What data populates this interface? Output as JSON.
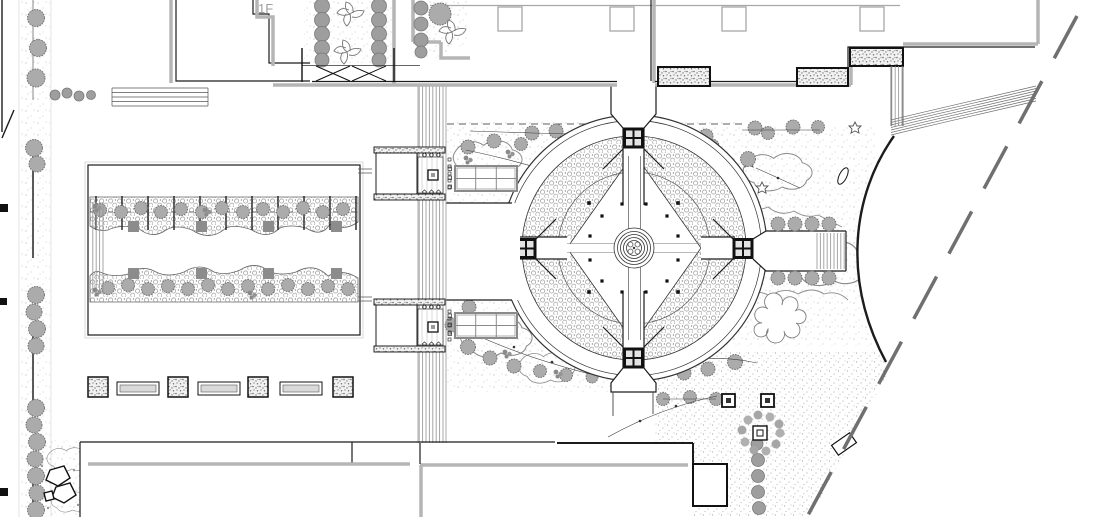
{
  "labels": {
    "floor": "1F"
  },
  "colors": {
    "background": "#ffffff",
    "linework": "#1c1c1c",
    "wall_gray": "#b5b5b5",
    "vegetation_gray": "#a9a9a9",
    "boundary_gray": "#707070",
    "label_gray": "#9e9e9e"
  },
  "features": [
    "site-boundary-dashed-line",
    "upper-building-block",
    "lower-building-blocks",
    "floor-label",
    "street-tree-row",
    "entry-gate-x-symbols",
    "courtyard-planting-beds",
    "stipple-planter-boxes",
    "curved-terrace-steps",
    "amphitheater-arc",
    "circular-parterre-garden",
    "central-fountain",
    "parterre-planting-ring",
    "axial-walkways",
    "pergola-node-squares",
    "east-gate-steps",
    "east-gate-tree-rows",
    "west-pergola-garden",
    "wavy-planting-bands",
    "bench-and-planter-row",
    "twin-pavilions",
    "trellis-grids",
    "boardwalk-stair-strip",
    "rock-cluster",
    "ornamental-tree-circle",
    "light-fixture-squares",
    "shrub-chains",
    "tie-line-annotations"
  ]
}
